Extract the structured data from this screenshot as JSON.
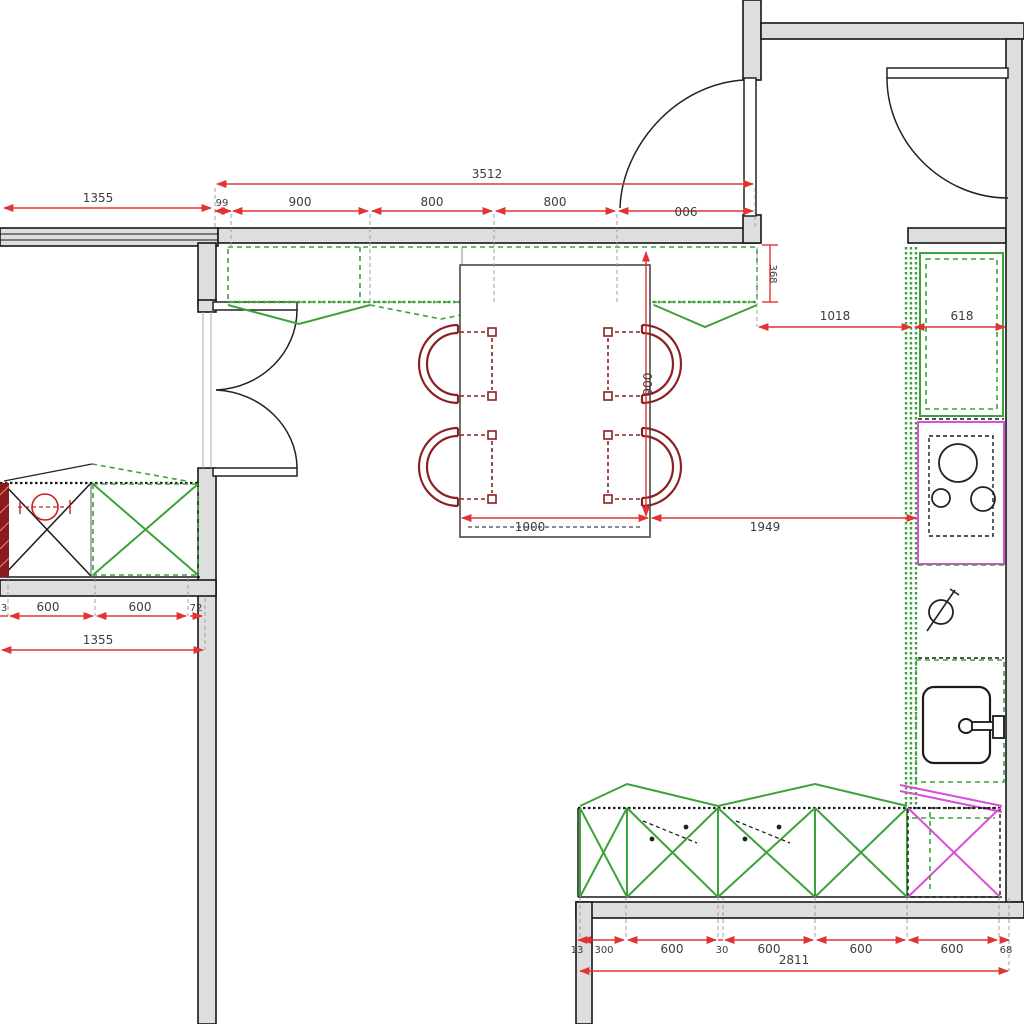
{
  "drawing": {
    "type": "kitchen-floor-plan",
    "units": "mm",
    "colors": {
      "dimension_red": "#e23333",
      "cabinet_green": "#3aa33a",
      "appliance_magenta": "#d94fd9",
      "chair_dark_red": "#8b2121",
      "wall_fill": "#dedede",
      "line_black": "#1a1a1a"
    },
    "fixtures": [
      "window",
      "entry-doors",
      "upper-cabinets",
      "dining-table",
      "chairs",
      "cooktop",
      "valve",
      "sink",
      "base-cabinets",
      "dishwasher"
    ]
  },
  "dimensions": {
    "top_wall": {
      "left_window_overall": "1355",
      "overall": "3512",
      "segments": [
        "99",
        "900",
        "800",
        "800",
        "900"
      ]
    },
    "right_side": {
      "wall_gap": "368",
      "offsets": [
        "1018",
        "618"
      ]
    },
    "table": {
      "width": "1000",
      "clearance_to_cabinets": "1949",
      "depth": "900"
    },
    "left_counter": {
      "segments": [
        "3",
        "600",
        "600",
        "72"
      ],
      "overall": "1355"
    },
    "bottom_counter": {
      "segments": [
        "13",
        "300",
        "600",
        "30",
        "600",
        "600",
        "600",
        "68"
      ],
      "overall": "2811"
    }
  }
}
